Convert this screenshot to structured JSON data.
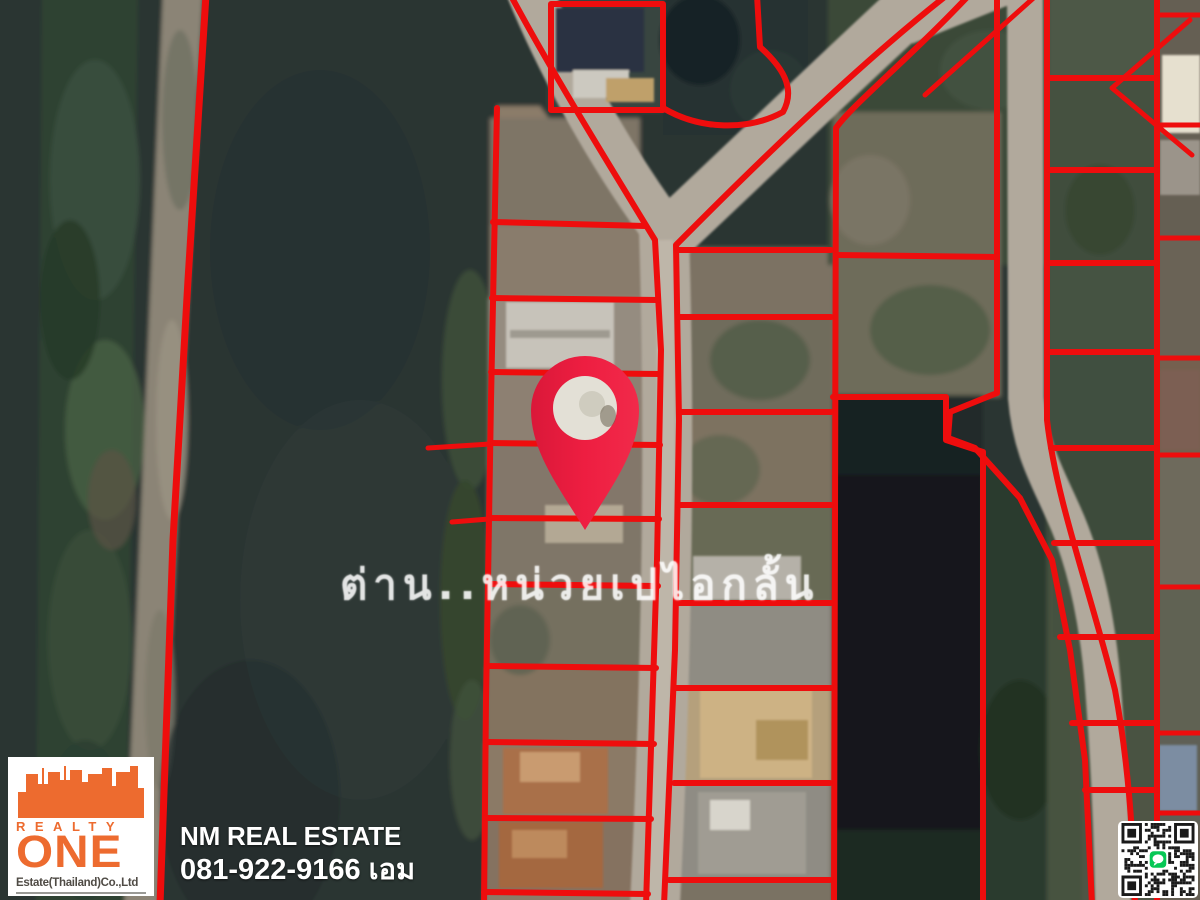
{
  "map": {
    "watermark_text": "ต่าน..หน่วยเปไอกลั้น",
    "pin_icon": "map-pin-icon",
    "colors": {
      "parcel_boundary": "#ee0d0d",
      "pin_red": "#ef1e42",
      "road_gray": "#b1a99c",
      "water_dark": "#2b3432",
      "pond_black": "#13191c"
    }
  },
  "footer": {
    "logo": {
      "realty_label": "REALTY",
      "one_label": "ONE",
      "company_label": "Estate(Thailand)Co.,Ltd",
      "orange": "#ed6b2f"
    },
    "agency_name": "NM REAL ESTATE",
    "phone_line": "081-922-9166 เอม",
    "qr_icon": "line-qr-code",
    "qr_badge_color": "#06c755"
  }
}
